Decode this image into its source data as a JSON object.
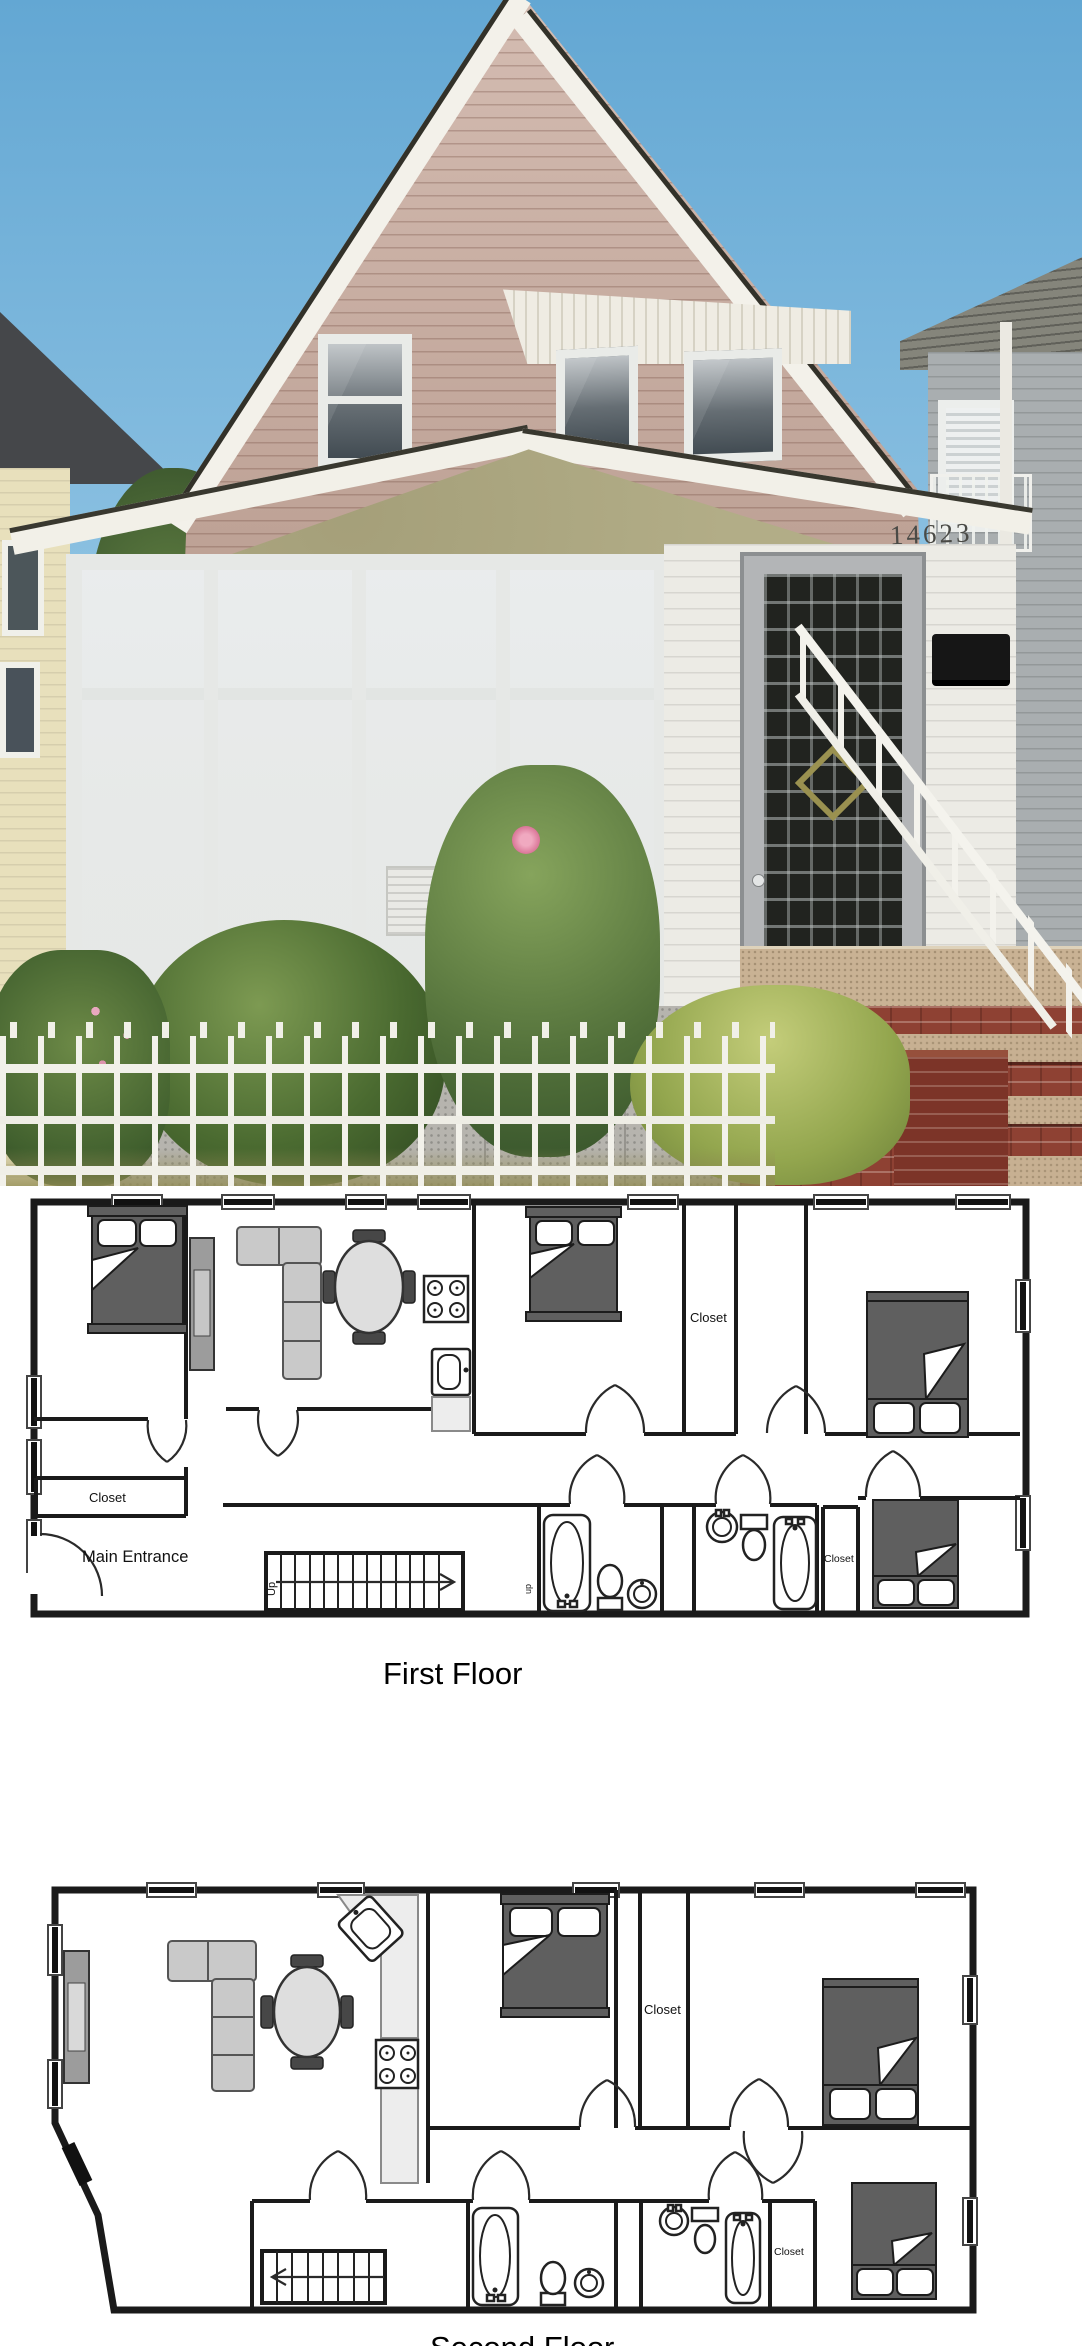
{
  "photo": {
    "house_number": "14623",
    "colors": {
      "sky": "#84bcdf",
      "gable_siding": "#c9ab9e",
      "trim_white": "#f2f0e8",
      "porch_stucco": "#b2ad87",
      "porch_white": "#ecebe5",
      "window_glass": "#39434a",
      "brick_steps": "#8e4133",
      "foliage": "#52703a",
      "fence": "#f2f1ea"
    }
  },
  "floor_plans": {
    "first": {
      "caption": "First Floor",
      "labels": {
        "closet_top": "Closet",
        "closet_entry": "Closet",
        "closet_back": "Closet",
        "main_entrance": "Main Entrance",
        "stairs_up": "Up",
        "stairs_up_small": "up"
      }
    },
    "second": {
      "caption": "Second Floor",
      "labels": {
        "closet_top": "Closet",
        "closet_back": "Closet"
      }
    }
  }
}
